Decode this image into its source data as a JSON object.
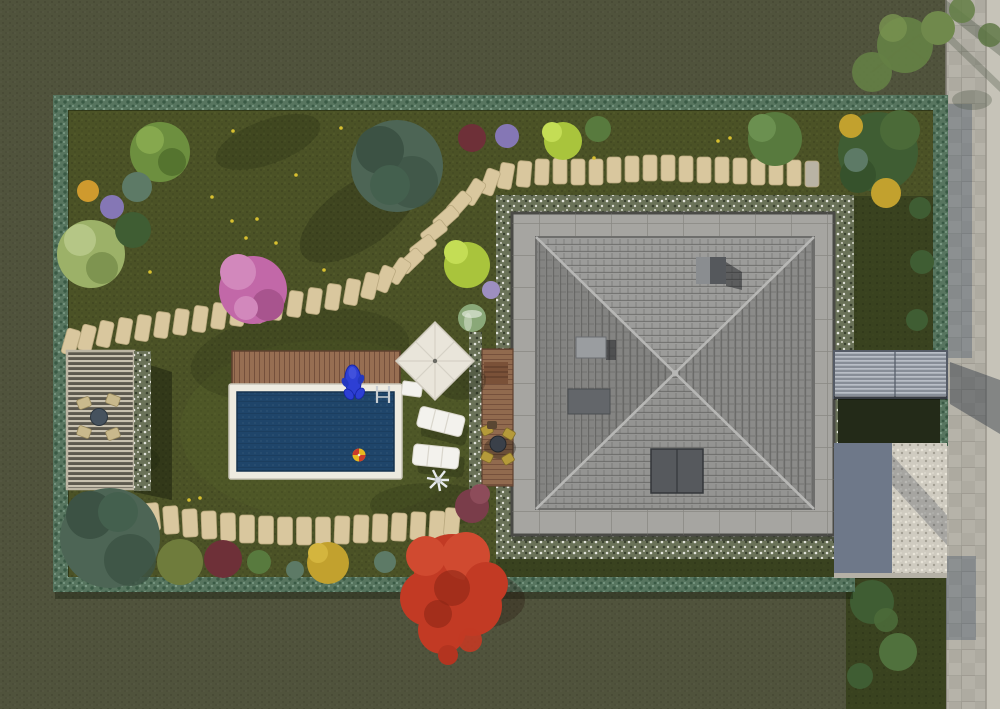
{
  "scene_title": "Aerial 3D render of a residential lot with garden, pool and hip-roof house",
  "objects": [
    "hedge border",
    "inner lawn",
    "outer lawn",
    "stepping-stone path",
    "swimming pool",
    "wooden pool deck",
    "dolphin pool float",
    "beach ball",
    "pool ladder",
    "square parasol",
    "sun loungers",
    "pool cleaner robot",
    "pergola with dining set",
    "timber dining deck",
    "hip-roof house",
    "chimney",
    "roof skylight",
    "roof vent",
    "paver walkway around house",
    "white flower bed",
    "slatted footbridge",
    "concrete driveway",
    "gravel pad",
    "sidewalk",
    "street trees",
    "japanese maple",
    "blue spruce",
    "pink flowering tree",
    "garden shrubs"
  ],
  "colors": {
    "grass_outer": "#50533c",
    "grass_inner": "#4b5226",
    "grass_dark": "#39421f",
    "hedge": "#57755f",
    "hedge_dark": "#3a5a45",
    "hedge_light": "#7b9a85",
    "stone": "#d9c79e",
    "stone_edge": "#b9a87e",
    "stone_gray": "#b9b3a4",
    "pool_water": "#1f456a",
    "pool_coping": "#eeebe0",
    "deck_wood": "#976e52",
    "deck_line": "#75503c",
    "roof_top": "#9c9c9a",
    "roof_right": "#8b8b89",
    "roof_bottom": "#949492",
    "roof_left": "#848482",
    "roof_ridge": "#b7b7b5",
    "paver": "#a6a5a1",
    "paver_line": "#6f6e6a",
    "flowerbed": "#6a7258",
    "chimney_dark": "#55585c",
    "chimney_light": "#8a8d90",
    "vent": "#63666a",
    "skylight": "#56595d",
    "sidewalk": "#b0ada3",
    "road": "#c6c3b8",
    "drive_concrete": "#6e7889",
    "gravel": "#cfcbc0",
    "bridge": "#878d97",
    "bridge_slat": "#c2c7cf",
    "umbrella": "#e9e5da",
    "umbrella_crease": "#d6d1c5",
    "lounger": "#f3f2ed",
    "furniture_tan": "#c9b98c",
    "table_dark": "#3a4049",
    "dolphin": "#2d3fd4",
    "ball_yellow": "#e8b820",
    "ball_red": "#cc3b2a",
    "maple": "#c23a24",
    "maple_dark": "#8e2616",
    "pink_tree": "#c268a8",
    "lime": "#a9c43c",
    "spruce": "#4d6555",
    "forest": "#3f5d33",
    "green_mid": "#587a3e",
    "green_light": "#9cb168",
    "palm": "#6d8f3f",
    "olive_bush": "#6f7c3c",
    "dark_red_bush": "#6e3038",
    "purple_bush": "#8577b5",
    "orange_bush": "#cf9a2e",
    "yellow_bush": "#c2a12e",
    "teal_bush": "#5d7a66",
    "hosta": "#8aa878",
    "maroon_bush": "#7a3d4a",
    "fern": "#647f45",
    "flower_yellow": "#d8c030"
  }
}
